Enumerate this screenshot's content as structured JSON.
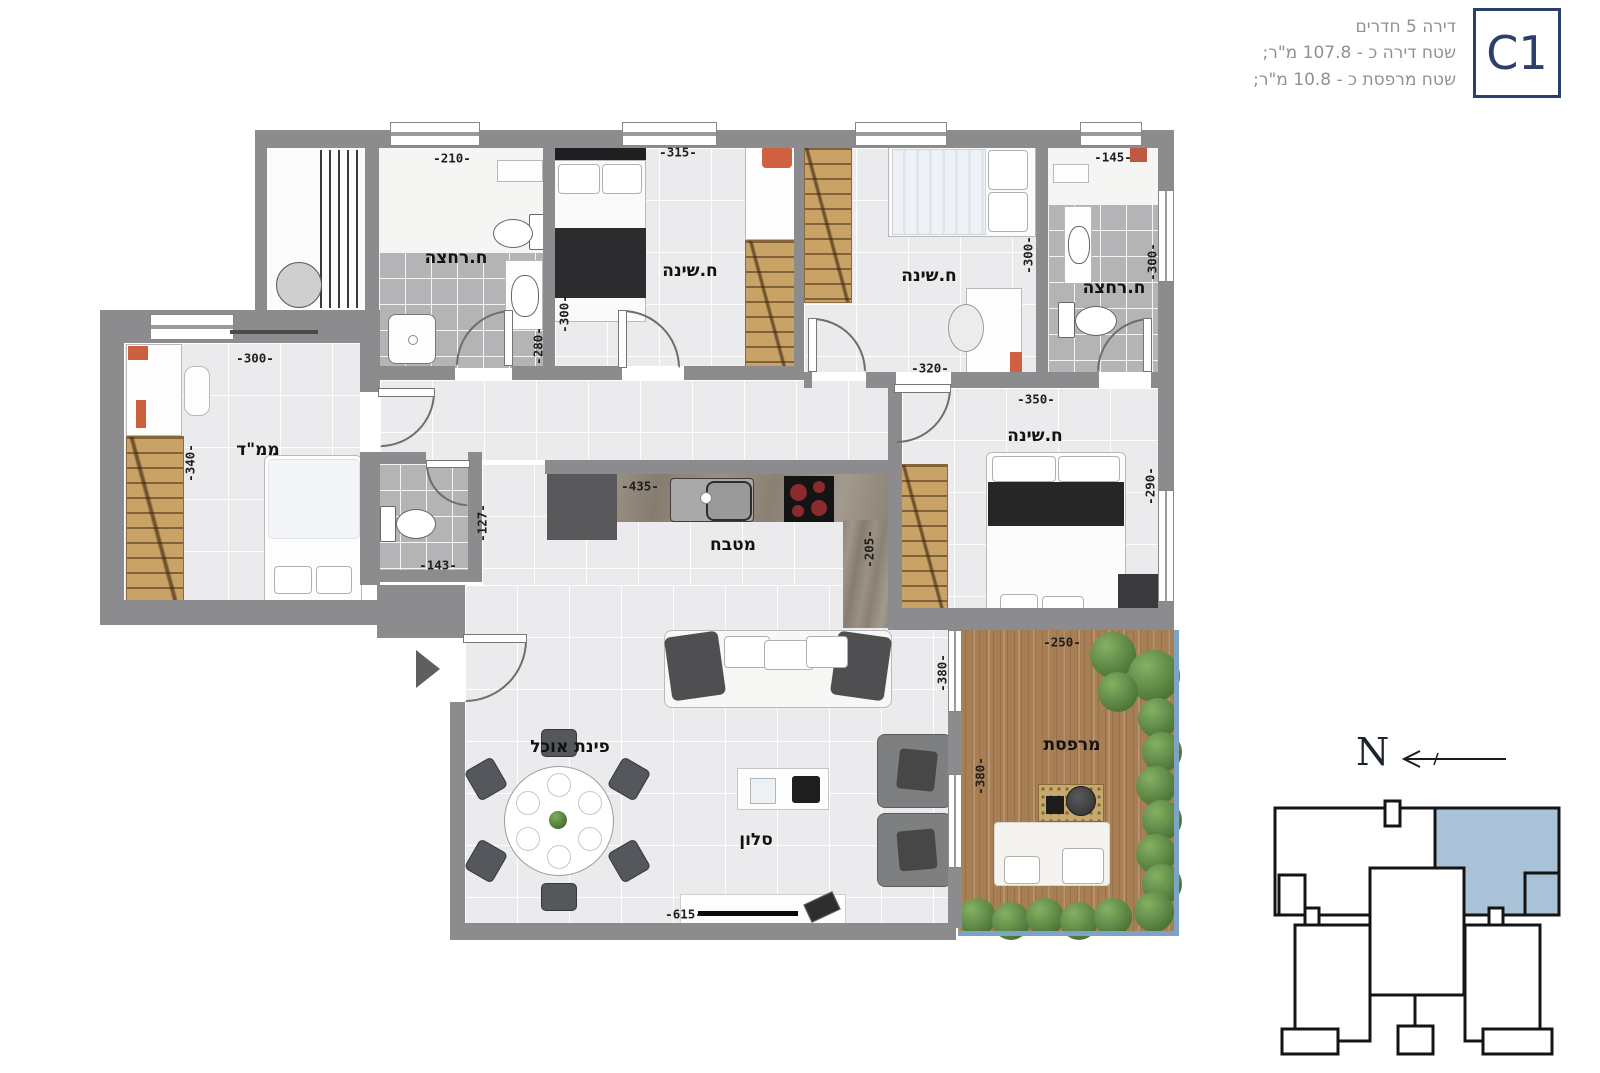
{
  "header": {
    "line1": "דירה 5 חדרים",
    "line2": "שטח דירה כ - 107.8 מ\"ר;",
    "line3": "שטח מרפסת כ - 10.8 מ\"ר;",
    "unit_code": "C1"
  },
  "rooms": {
    "bath1": "ח.רחצה",
    "bed1": "ח.שינה",
    "bed2": "ח.שינה",
    "bath2": "ח.רחצה",
    "mamad": "ממ\"ד",
    "kitchen": "מטבח",
    "master": "ח.שינה",
    "dining": "פינת אוכל",
    "living": "סלון",
    "balcony": "מרפסת"
  },
  "dimensions": {
    "bath1_top": "-210-",
    "bed1_top": "-315-",
    "bed1_left": "-300-",
    "bath1_right": "-280-",
    "bed2_bottom": "-320-",
    "bed2_right": "-300-",
    "bath2_top": "-145-",
    "bath2_right": "-300-",
    "master_top": "-350-",
    "master_right": "-290-",
    "mamad_top": "-300-",
    "mamad_left": "-340-",
    "wc_bottom": "-143-",
    "wc_right": "-127-",
    "kitchen_top": "-435-",
    "kitchen_right": "-205-",
    "living_bottom": "-615-",
    "living_right": "-380-",
    "balcony_top": "-250-",
    "balcony_left": "-380-"
  },
  "compass": {
    "north_label": "N"
  },
  "colors": {
    "accent_navy": "#2c3e6b",
    "keyplan_highlight": "#a9c2d8",
    "wall_gray": "#8c8c8e",
    "header_text_gray": "#8d9297",
    "wood": "#c9a266",
    "deck": "#a87e54",
    "greenery": "#5f8f4a",
    "railing_blue": "#7ea4c4"
  }
}
